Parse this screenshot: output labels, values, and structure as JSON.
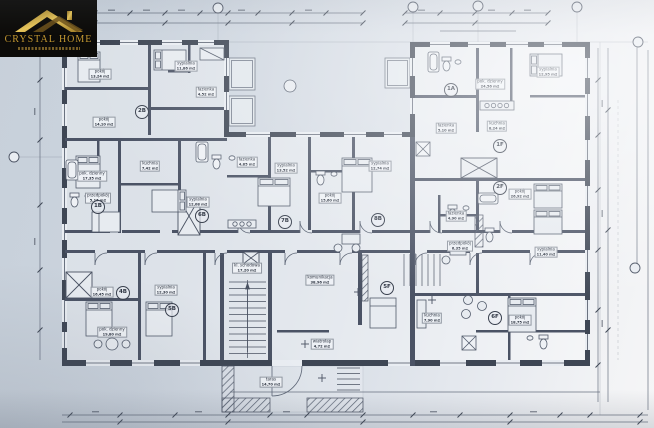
{
  "logo": {
    "brand": "CRYSTAL HOME"
  },
  "plan": {
    "units": [
      {
        "id": "1A",
        "x": 451,
        "y": 90
      },
      {
        "id": "2B",
        "x": 142,
        "y": 112
      },
      {
        "id": "1B",
        "x": 98,
        "y": 207
      },
      {
        "id": "6B",
        "x": 202,
        "y": 216
      },
      {
        "id": "7B",
        "x": 285,
        "y": 222
      },
      {
        "id": "8B",
        "x": 378,
        "y": 220
      },
      {
        "id": "1F",
        "x": 500,
        "y": 146
      },
      {
        "id": "2F",
        "x": 500,
        "y": 188
      },
      {
        "id": "4B",
        "x": 123,
        "y": 293
      },
      {
        "id": "5B",
        "x": 172,
        "y": 310
      },
      {
        "id": "5F",
        "x": 387,
        "y": 288
      },
      {
        "id": "6F",
        "x": 495,
        "y": 318
      }
    ],
    "rooms": [
      {
        "name": "pokój",
        "area": "13,24 m2",
        "x": 100,
        "y": 74
      },
      {
        "name": "sypialnia",
        "area": "11,86 m2",
        "x": 186,
        "y": 66
      },
      {
        "name": "łazienka",
        "area": "4,52 m2",
        "x": 206,
        "y": 92
      },
      {
        "name": "pokój",
        "area": "14,10 m2",
        "x": 104,
        "y": 122
      },
      {
        "name": "pok. dzienny",
        "area": "17,35 m2",
        "x": 92,
        "y": 176
      },
      {
        "name": "kuchnia",
        "area": "7,42 m2",
        "x": 150,
        "y": 166
      },
      {
        "name": "przedpokój",
        "area": "5,16 m2",
        "x": 98,
        "y": 198
      },
      {
        "name": "sypialnia",
        "area": "12,08 m2",
        "x": 198,
        "y": 202
      },
      {
        "name": "łazienka",
        "area": "4,85 m2",
        "x": 247,
        "y": 162
      },
      {
        "name": "sypialnia",
        "area": "13,52 m2",
        "x": 286,
        "y": 168
      },
      {
        "name": "pokój",
        "area": "15,60 m2",
        "x": 330,
        "y": 198
      },
      {
        "name": "sypialnia",
        "area": "12,74 m2",
        "x": 380,
        "y": 166
      },
      {
        "name": "komunikacja",
        "area": "38,96 m2",
        "x": 320,
        "y": 280
      },
      {
        "name": "kl. schodowa",
        "area": "17,20 m2",
        "x": 247,
        "y": 268
      },
      {
        "name": "pokój",
        "area": "16,45 m2",
        "x": 102,
        "y": 292
      },
      {
        "name": "sypialnia",
        "area": "12,30 m2",
        "x": 166,
        "y": 290
      },
      {
        "name": "pok. dzienny",
        "area": "19,80 m2",
        "x": 112,
        "y": 332
      },
      {
        "name": "taras",
        "area": "14,70 m2",
        "x": 271,
        "y": 382
      },
      {
        "name": "wiatrołap",
        "area": "4,72 m2",
        "x": 322,
        "y": 344
      },
      {
        "name": "pok. dzienny",
        "area": "24,56 m2",
        "x": 490,
        "y": 84
      },
      {
        "name": "sypialnia",
        "area": "12,95 m2",
        "x": 548,
        "y": 72
      },
      {
        "name": "kuchnia",
        "area": "8,24 m2",
        "x": 497,
        "y": 126
      },
      {
        "name": "łazienka",
        "area": "5,10 m2",
        "x": 446,
        "y": 128
      },
      {
        "name": "pokój",
        "area": "26,92 m2",
        "x": 520,
        "y": 194
      },
      {
        "name": "łazienka",
        "area": "4,90 m2",
        "x": 456,
        "y": 216
      },
      {
        "name": "przedpokój",
        "area": "6,35 m2",
        "x": 460,
        "y": 246
      },
      {
        "name": "sypialnia",
        "area": "11,40 m2",
        "x": 546,
        "y": 252
      },
      {
        "name": "pokój",
        "area": "18,75 m2",
        "x": 520,
        "y": 320
      },
      {
        "name": "kuchnia",
        "area": "7,90 m2",
        "x": 432,
        "y": 318
      }
    ]
  }
}
